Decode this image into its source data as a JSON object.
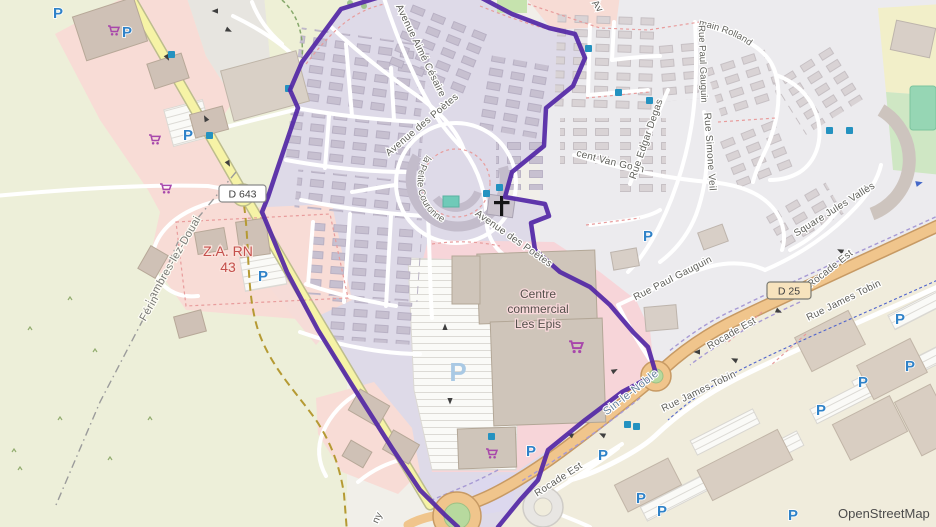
{
  "map": {
    "attribution": "OpenStreetMap",
    "street_labels": {
      "aime_cesaire": "Avenue Aimé Césaire",
      "poetes_1": "Avenue des Poètes",
      "poetes_2": "Avenue des Poètes",
      "petite_couronne": "Résidence de la Petite Couronne",
      "van_gogh": "Rue Vincent Van Gogh",
      "edgar_degas": "Rue Edgar Degas",
      "simone_veil": "Rue Simone Veil",
      "romain_rolland": "Square Romain Rolland",
      "paul_gauguin_north": "Rue Paul Gauguin",
      "paul_gauguin_south": "Rue Paul Gauguin",
      "jules_valles": "Square Jules Vallès",
      "james_tobin_1": "Rue James Tobin",
      "james_tobin_2": "Rue James Tobin",
      "rocade_est_1": "Rocade Est",
      "rocade_est_2": "Rocade Est",
      "rocade_est_3": "Rocade Est",
      "avenue_fragment": "Av",
      "street_fragment": "ny"
    },
    "place_labels": {
      "lambres": "Lambres-lez-Douai",
      "ferin": "Férin",
      "sin_le_noble": "Sin-le-Noble",
      "za_line1": "Z.A. RN",
      "za_line2": "43",
      "mall_line1": "Centre",
      "mall_line2": "commercial",
      "mall_line3": "Les Epis"
    },
    "road_shields": {
      "d643": "D 643",
      "d25": "D 25"
    },
    "icons": {
      "parking_letter": "P"
    },
    "colors": {
      "boundary_purple": "#5227a5",
      "parking_blue": "#2f82c8",
      "shop_purple": "#a847ab",
      "bus_stop_blue": "#2492c0",
      "primary_road_orange": "#f0c58c",
      "secondary_road_yellow": "#f6f3a6",
      "retail_pink": "#f8dcd6",
      "selected_area_lavender": "#dedae8",
      "za_label_red": "#c4504c"
    }
  }
}
